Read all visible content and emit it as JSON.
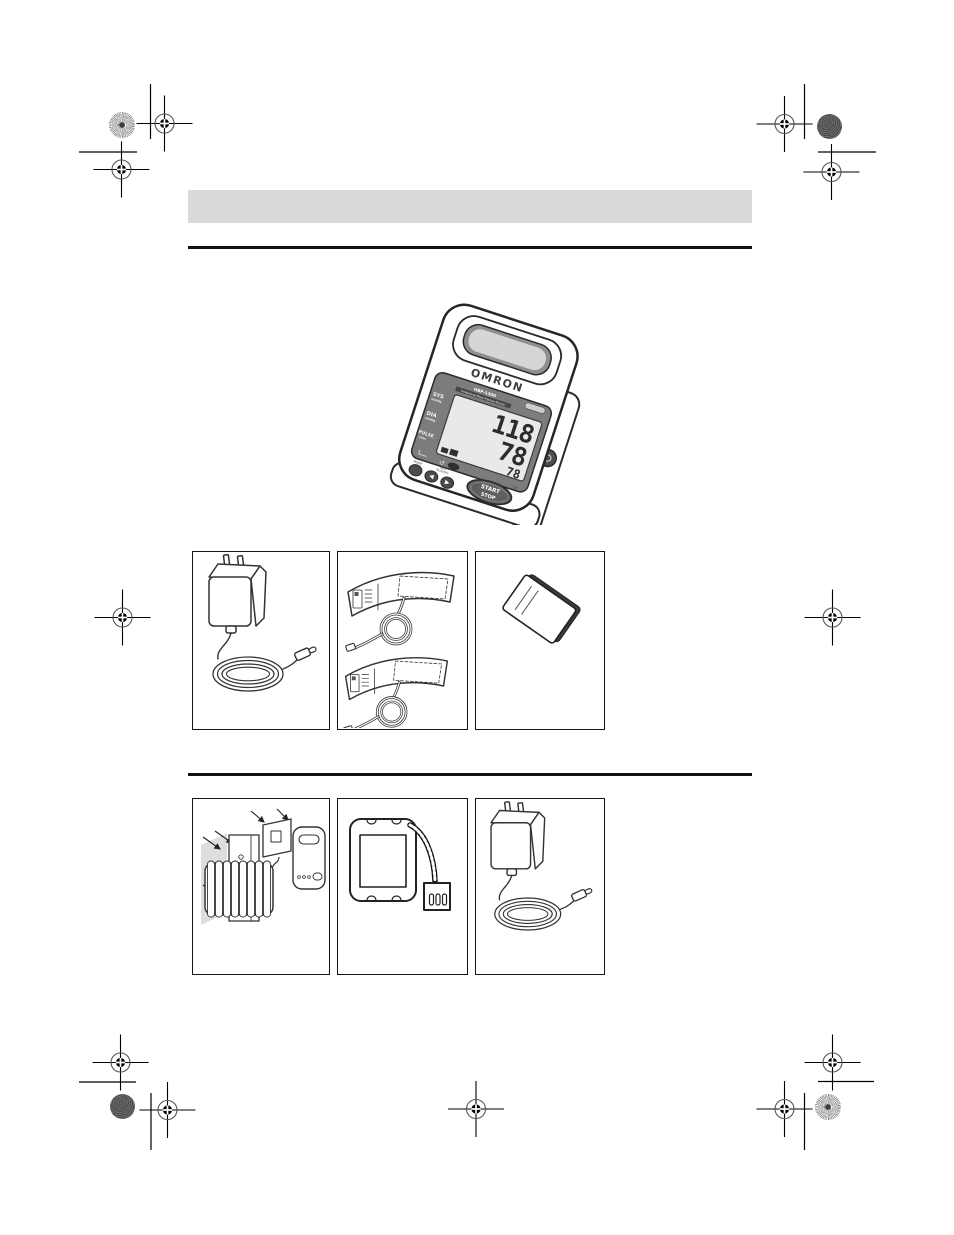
{
  "page": {
    "background": "#ffffff",
    "header_bar_color": "#d9d9d9",
    "rule_color": "#111111"
  },
  "print_marks": {
    "registration_target_icon": "crosshair-registration-mark",
    "sunburst_patch_icon": "sunburst-color-control-patch",
    "halftone_patch_icon": "halftone-color-control-patch"
  },
  "device": {
    "brand": "OMRON",
    "model": "HBP-1300",
    "tagline": "Professional Blood Pressure Monitor",
    "lcd": {
      "sys_label": "SYS",
      "sys_unit": "mmHg",
      "sys_value": "118",
      "dia_label": "DIA",
      "dia_unit": "mmHg",
      "dia_value": "78",
      "pulse_label": "PULSE",
      "pulse_unit": "/min",
      "pulse_value": "78"
    },
    "controls": {
      "mode_label": "MODE",
      "last_reading_line1": "LAST",
      "last_reading_line2": "READING",
      "power_label": "O/I",
      "start_label": "START",
      "stop_label": "STOP"
    }
  },
  "included_items": {
    "row1": [
      "ac-adapter-with-cord",
      "arm-cuffs-with-tube",
      "instruction-manual"
    ],
    "row2": [
      "battery-holder-mounting-kit",
      "rechargeable-battery-pack",
      "ac-adapter-with-cord"
    ]
  }
}
